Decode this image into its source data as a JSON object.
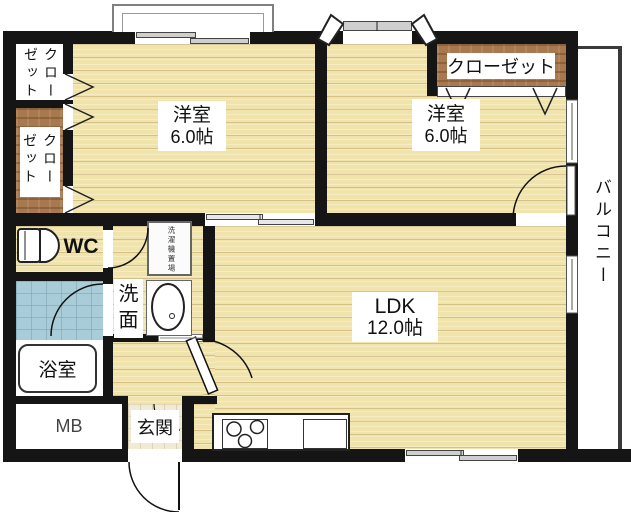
{
  "plan_title": "2LDK floor plan",
  "rooms": {
    "bedroom1": {
      "label": "洋室",
      "size": "6.0帖"
    },
    "bedroom2": {
      "label": "洋室",
      "size": "6.0帖"
    },
    "ldk": {
      "label": "LDK",
      "size": "12.0帖"
    },
    "closet_left_top": {
      "label": "クローゼット"
    },
    "closet_left_bottom": {
      "label": "クローゼット"
    },
    "closet_right": {
      "label": "クローゼット"
    },
    "wc": {
      "label": "WC"
    },
    "washroom": {
      "label": "洗面"
    },
    "laundry": {
      "label": "洗濯機置場"
    },
    "bathroom": {
      "label": "浴室"
    },
    "meter_box": {
      "label": "MB"
    },
    "entrance": {
      "label": "玄関"
    },
    "balcony": {
      "label": "バルコニー"
    }
  },
  "colors": {
    "wall": "#151515",
    "floor_wood": "#f0e3ab",
    "closet_wood": "#a8794e",
    "bath_tile": "#a9ccd9",
    "background": "#ffffff"
  }
}
